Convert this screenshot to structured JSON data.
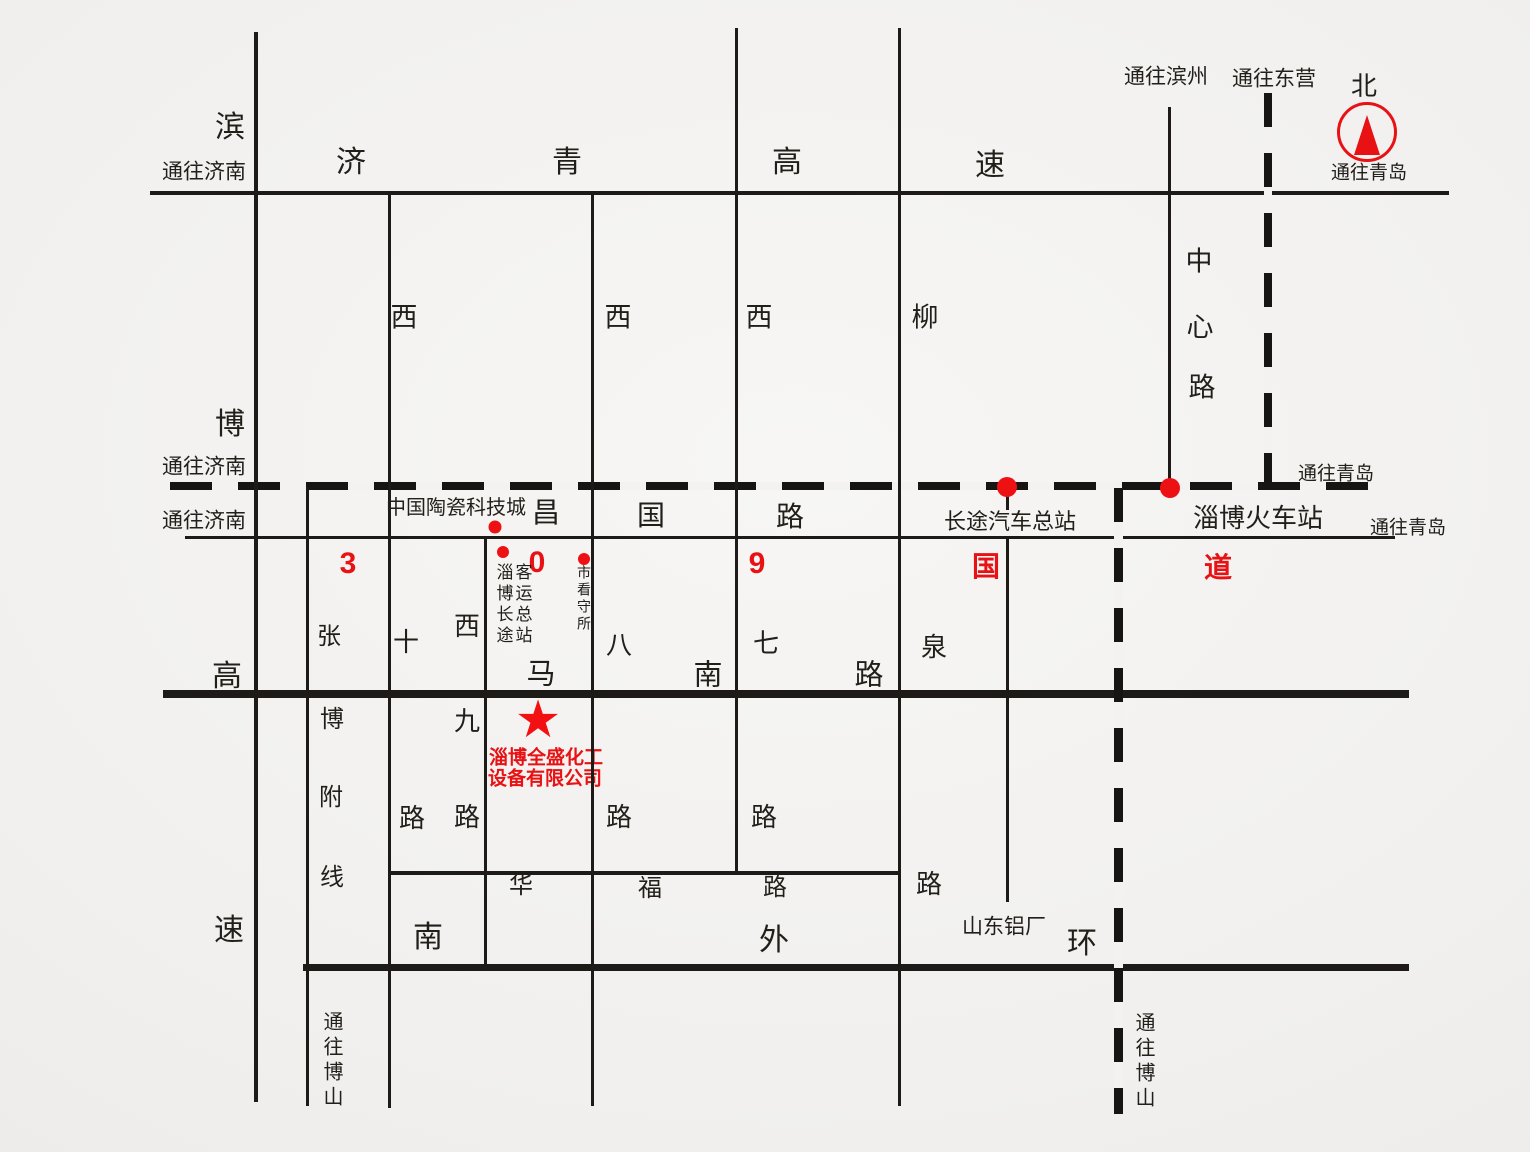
{
  "map": {
    "background": "#f1f0ee",
    "ink": "#221e1a",
    "red": "#e81113",
    "compass": {
      "north_label": "北",
      "direction_label": "通往青岛",
      "cx": 1367,
      "cy": 132,
      "r": 27
    },
    "company": {
      "star": "★",
      "star_x": 538,
      "star_y": 720,
      "star_size": 52,
      "line1": "淄博全盛化工",
      "line2": "设备有限公司",
      "l1x": 546,
      "l1y": 758,
      "l2x": 545,
      "l2y": 779,
      "font_size": 19
    },
    "route_number": "309国道",
    "lines": [
      {
        "name": "jiqing-expressway-line",
        "dir": "h",
        "x": 150,
        "y": 193,
        "len": 1299,
        "thick": 4
      },
      {
        "name": "jiaoji-railway-line",
        "dir": "h",
        "x": 170,
        "y": 486,
        "len": 1220,
        "thick": 8,
        "style": "rail"
      },
      {
        "name": "changguo-road-line",
        "dir": "h",
        "x": 185,
        "y": 537,
        "len": 1210,
        "thick": 3
      },
      {
        "name": "manan-road-line",
        "dir": "h",
        "x": 163,
        "y": 694,
        "len": 1246,
        "thick": 8
      },
      {
        "name": "huafu-road-line",
        "dir": "h",
        "x": 388,
        "y": 873,
        "len": 511,
        "thick": 4
      },
      {
        "name": "south-outer-ring-line",
        "dir": "h",
        "x": 303,
        "y": 967,
        "len": 1106,
        "thick": 7
      },
      {
        "name": "binbo-expressway-line",
        "dir": "v",
        "x": 256,
        "y": 32,
        "len": 1070,
        "thick": 4
      },
      {
        "name": "zhangbo-branch-line",
        "dir": "v",
        "x": 307,
        "y": 487,
        "len": 619,
        "thick": 3
      },
      {
        "name": "xishi-road-line",
        "dir": "v",
        "x": 389,
        "y": 193,
        "len": 915,
        "thick": 3
      },
      {
        "name": "xijiu-road-line",
        "dir": "v",
        "x": 485,
        "y": 537,
        "len": 432,
        "thick": 3
      },
      {
        "name": "xiba-road-line",
        "dir": "v",
        "x": 592,
        "y": 193,
        "len": 913,
        "thick": 3
      },
      {
        "name": "xiqi-road-line",
        "dir": "v",
        "x": 736,
        "y": 28,
        "len": 847,
        "thick": 3
      },
      {
        "name": "liuquan-road-line",
        "dir": "v",
        "x": 899,
        "y": 28,
        "len": 1078,
        "thick": 3
      },
      {
        "name": "bus-terminal-road-line",
        "dir": "v",
        "x": 1007,
        "y": 537,
        "len": 365,
        "thick": 3
      },
      {
        "name": "bus-terminal-tick",
        "dir": "v",
        "x": 1007,
        "y": 490,
        "len": 20,
        "thick": 3
      },
      {
        "name": "zhongxin-road-line",
        "dir": "v",
        "x": 1169,
        "y": 107,
        "len": 380,
        "thick": 3
      },
      {
        "name": "dongying-dashed-line",
        "dir": "v",
        "x": 1268,
        "y": 93,
        "len": 394,
        "thick": 8,
        "style": "rail"
      },
      {
        "name": "boshan-railway-line",
        "dir": "v",
        "x": 1118,
        "y": 488,
        "len": 626,
        "thick": 9,
        "style": "rail"
      }
    ],
    "labels": [
      {
        "name": "binbo-expressway-char-bin",
        "text": "滨",
        "x": 230,
        "y": 128,
        "size": 30
      },
      {
        "name": "to-jinan-top",
        "text": "通往济南",
        "x": 204,
        "y": 172,
        "size": 21
      },
      {
        "name": "jiqing-expressway-char-ji",
        "text": "济",
        "x": 351,
        "y": 163,
        "size": 30
      },
      {
        "name": "jiqing-expressway-char-qing",
        "text": "青",
        "x": 567,
        "y": 163,
        "size": 30
      },
      {
        "name": "jiqing-expressway-char-gao",
        "text": "高",
        "x": 787,
        "y": 163,
        "size": 30
      },
      {
        "name": "jiqing-expressway-char-su",
        "text": "速",
        "x": 990,
        "y": 166,
        "size": 30
      },
      {
        "name": "to-binzhou",
        "text": "通往滨州",
        "x": 1166,
        "y": 77,
        "size": 21
      },
      {
        "name": "to-dongying",
        "text": "通往东营",
        "x": 1274,
        "y": 79,
        "size": 21
      },
      {
        "name": "xishi-road-char-xi",
        "text": "西",
        "x": 404,
        "y": 318,
        "size": 27
      },
      {
        "name": "xiba-road-char-xi",
        "text": "西",
        "x": 618,
        "y": 318,
        "size": 27
      },
      {
        "name": "xiqi-road-char-xi",
        "text": "西",
        "x": 759,
        "y": 318,
        "size": 27
      },
      {
        "name": "liuquan-road-char-liu",
        "text": "柳",
        "x": 925,
        "y": 318,
        "size": 27
      },
      {
        "name": "zhongxin-road-char-zhong",
        "text": "中",
        "x": 1199,
        "y": 262,
        "size": 27
      },
      {
        "name": "zhongxin-road-char-xin",
        "text": "心",
        "x": 1200,
        "y": 328,
        "size": 27
      },
      {
        "name": "zhongxin-road-char-lu",
        "text": "路",
        "x": 1202,
        "y": 388,
        "size": 27
      },
      {
        "name": "binbo-expressway-char-bo",
        "text": "博",
        "x": 230,
        "y": 425,
        "size": 30
      },
      {
        "name": "to-jinan-railway",
        "text": "通往济南",
        "x": 204,
        "y": 467,
        "size": 21
      },
      {
        "name": "to-jinan-changguo",
        "text": "通往济南",
        "x": 204,
        "y": 521,
        "size": 21
      },
      {
        "name": "ceramic-city",
        "text": "中国陶瓷科技城",
        "x": 456,
        "y": 508,
        "size": 20
      },
      {
        "name": "changguo-road-char-chang",
        "text": "昌",
        "x": 546,
        "y": 513,
        "size": 28
      },
      {
        "name": "changguo-road-char-guo",
        "text": "国",
        "x": 651,
        "y": 516,
        "size": 28
      },
      {
        "name": "changguo-road-char-lu",
        "text": "路",
        "x": 790,
        "y": 517,
        "size": 28
      },
      {
        "name": "bus-terminal",
        "text": "长途汽车总站",
        "x": 1010,
        "y": 522,
        "size": 22
      },
      {
        "name": "railway-station",
        "text": "淄博火车站",
        "x": 1258,
        "y": 518,
        "size": 26
      },
      {
        "name": "to-qingdao-railway",
        "text": "通往青岛",
        "x": 1336,
        "y": 474,
        "size": 19
      },
      {
        "name": "to-qingdao-changguo",
        "text": "通往青岛",
        "x": 1408,
        "y": 528,
        "size": 19
      },
      {
        "name": "route309-digit-3",
        "text": "3",
        "x": 348,
        "y": 564,
        "size": 30,
        "color": "red"
      },
      {
        "name": "route309-digit-0",
        "text": "0",
        "x": 537,
        "y": 563,
        "size": 30,
        "color": "red"
      },
      {
        "name": "route309-digit-9",
        "text": "9",
        "x": 757,
        "y": 564,
        "size": 30,
        "color": "red"
      },
      {
        "name": "route309-char-guo",
        "text": "国",
        "x": 986,
        "y": 567,
        "size": 28,
        "color": "red"
      },
      {
        "name": "route309-char-dao",
        "text": "道",
        "x": 1218,
        "y": 568,
        "size": 28,
        "color": "red"
      },
      {
        "name": "passenger-terminal-col-left",
        "text": "淄博长途",
        "x": 503,
        "y": 605,
        "size": 17,
        "vertical": true,
        "spacing": 4
      },
      {
        "name": "passenger-terminal-col-right",
        "text": "客运总站",
        "x": 522,
        "y": 605,
        "size": 17,
        "vertical": true,
        "spacing": 4
      },
      {
        "name": "detention-center",
        "text": "市看守所",
        "x": 584,
        "y": 599,
        "size": 14,
        "vertical": true,
        "spacing": 3
      },
      {
        "name": "zhangbo-branch-char-zhang",
        "text": "张",
        "x": 329,
        "y": 637,
        "size": 24
      },
      {
        "name": "xishi-road-char-shi",
        "text": "十",
        "x": 406,
        "y": 642,
        "size": 26
      },
      {
        "name": "xijiu-road-char-xi",
        "text": "西",
        "x": 467,
        "y": 626,
        "size": 26
      },
      {
        "name": "xiba-road-char-ba",
        "text": "八",
        "x": 619,
        "y": 645,
        "size": 26
      },
      {
        "name": "xiqi-road-char-qi",
        "text": "七",
        "x": 766,
        "y": 643,
        "size": 26
      },
      {
        "name": "liuquan-road-char-quan",
        "text": "泉",
        "x": 934,
        "y": 647,
        "size": 26
      },
      {
        "name": "binbo-expressway-char-gao",
        "text": "高",
        "x": 227,
        "y": 677,
        "size": 30
      },
      {
        "name": "manan-road-char-ma",
        "text": "马",
        "x": 541,
        "y": 675,
        "size": 29
      },
      {
        "name": "manan-road-char-nan",
        "text": "南",
        "x": 708,
        "y": 676,
        "size": 29
      },
      {
        "name": "manan-road-char-lu",
        "text": "路",
        "x": 869,
        "y": 676,
        "size": 29
      },
      {
        "name": "zhangbo-branch-char-bo",
        "text": "博",
        "x": 332,
        "y": 720,
        "size": 24
      },
      {
        "name": "xijiu-road-char-jiu",
        "text": "九",
        "x": 467,
        "y": 721,
        "size": 26
      },
      {
        "name": "zhangbo-branch-char-fu",
        "text": "附",
        "x": 331,
        "y": 798,
        "size": 24
      },
      {
        "name": "xishi-road-char-lu",
        "text": "路",
        "x": 412,
        "y": 818,
        "size": 26
      },
      {
        "name": "xijiu-road-char-lu",
        "text": "路",
        "x": 467,
        "y": 817,
        "size": 26
      },
      {
        "name": "xiba-road-char-lu",
        "text": "路",
        "x": 619,
        "y": 817,
        "size": 26
      },
      {
        "name": "xiqi-road-char-lu",
        "text": "路",
        "x": 764,
        "y": 817,
        "size": 26
      },
      {
        "name": "zhangbo-branch-char-xian",
        "text": "线",
        "x": 332,
        "y": 878,
        "size": 24
      },
      {
        "name": "huafu-road-char-hua",
        "text": "华",
        "x": 521,
        "y": 886,
        "size": 24
      },
      {
        "name": "huafu-road-char-fu",
        "text": "福",
        "x": 650,
        "y": 889,
        "size": 24
      },
      {
        "name": "huafu-road-char-lu",
        "text": "路",
        "x": 775,
        "y": 888,
        "size": 24
      },
      {
        "name": "liuquan-road-char-lu",
        "text": "路",
        "x": 929,
        "y": 884,
        "size": 26
      },
      {
        "name": "shandong-aluminum-plant",
        "text": "山东铝厂",
        "x": 1004,
        "y": 927,
        "size": 21
      },
      {
        "name": "south-ring-char-nan",
        "text": "南",
        "x": 428,
        "y": 938,
        "size": 30
      },
      {
        "name": "south-ring-char-wai",
        "text": "外",
        "x": 774,
        "y": 941,
        "size": 30
      },
      {
        "name": "south-ring-char-huan",
        "text": "环",
        "x": 1082,
        "y": 944,
        "size": 30
      },
      {
        "name": "binbo-expressway-char-su",
        "text": "速",
        "x": 229,
        "y": 931,
        "size": 30
      },
      {
        "name": "to-boshan-left",
        "text": "通往博山",
        "x": 331,
        "y": 1061,
        "size": 20,
        "vertical": true,
        "spacing": 5
      },
      {
        "name": "to-boshan-right",
        "text": "通往博山",
        "x": 1143,
        "y": 1062,
        "size": 20,
        "vertical": true,
        "spacing": 5
      }
    ],
    "dots": [
      {
        "name": "ceramic-city-dot",
        "x": 495,
        "y": 527,
        "d": 13
      },
      {
        "name": "passenger-terminal-dot",
        "x": 503,
        "y": 552,
        "d": 12
      },
      {
        "name": "detention-center-dot",
        "x": 584,
        "y": 559,
        "d": 12
      },
      {
        "name": "bus-terminal-dot",
        "x": 1007,
        "y": 487,
        "d": 20
      },
      {
        "name": "railway-station-dot",
        "x": 1170,
        "y": 488,
        "d": 20
      }
    ]
  }
}
